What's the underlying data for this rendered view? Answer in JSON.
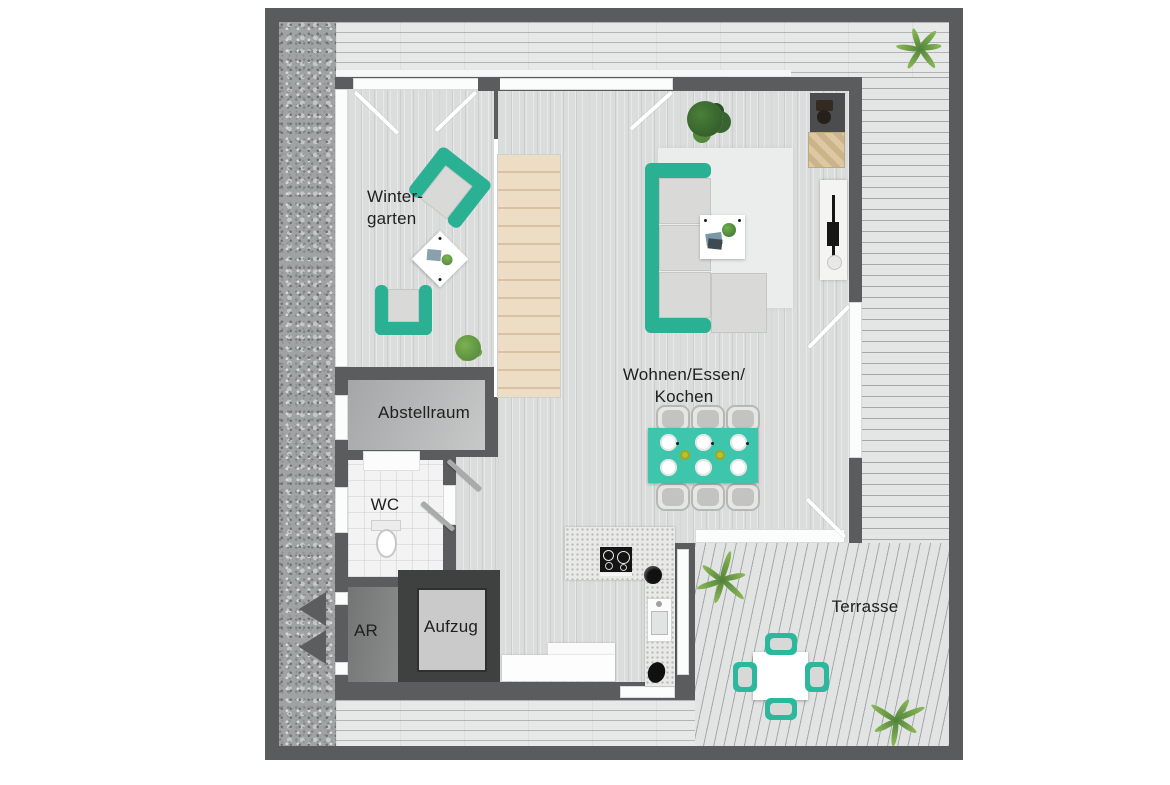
{
  "plan": {
    "rooms": {
      "wintergarten": {
        "label_line1": "Winter-",
        "label_line2": "garten"
      },
      "abstellraum": {
        "label": "Abstellraum"
      },
      "wc": {
        "label": "WC"
      },
      "ar": {
        "label": "AR"
      },
      "aufzug": {
        "label": "Aufzug"
      },
      "wohnen": {
        "label_line1": "Wohnen/Essen/",
        "label_line2": "Kochen"
      },
      "terrasse": {
        "label": "Terrasse"
      }
    },
    "colors": {
      "outer_site_wall": "#595b5c",
      "unit_wall": "#5a5c5d",
      "sofa_armchair_teal": "#2ab092",
      "dining_table_teal": "#3ec6ac",
      "terrace_chair_teal": "#2cb89c",
      "stairs_beige": "#e9dabf",
      "deck_gray": "#e6e7e7",
      "gravel_gray": "#a0a3a4",
      "interior_floor_gray": "#dbdcdc",
      "wood_sideboard_tan": "#d9c49e",
      "label_text": "#1f1f1f"
    },
    "furniture_icons": [
      "armchair",
      "side-table",
      "staircase",
      "sofa",
      "chaise",
      "rug",
      "coffee-table",
      "potted-plant",
      "fireplace-block",
      "wood-sideboard",
      "tv-board",
      "dining-table",
      "dining-chair",
      "plate",
      "bowl",
      "kitchen-counter",
      "cooktop",
      "round-sink",
      "kitchen-sink",
      "kettle",
      "bench",
      "wc-vanity",
      "toilet",
      "elevator-car",
      "terrace-table",
      "terrace-chair",
      "fern-plant",
      "entrance-chevrons",
      "door-swing"
    ]
  }
}
